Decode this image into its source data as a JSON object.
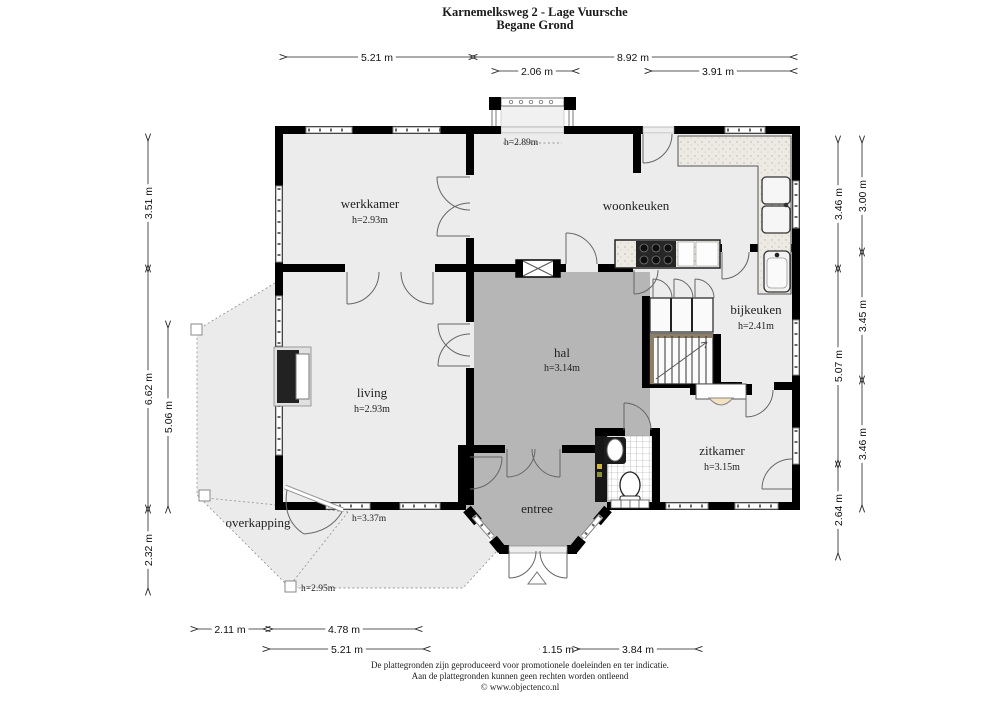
{
  "title": {
    "line1": "Karnemelksweg 2 - Lage Vuursche",
    "line2": "Begane Grond"
  },
  "rooms": {
    "werkkamer": {
      "label": "werkkamer",
      "height": "h=2.93m"
    },
    "woonkeuken": {
      "label": "woonkeuken"
    },
    "bijkeuken": {
      "label": "bijkeuken",
      "height": "h=2.41m"
    },
    "hal": {
      "label": "hal",
      "height": "h=3.14m"
    },
    "living": {
      "label": "living",
      "height": "h=2.93m"
    },
    "zitkamer": {
      "label": "zitkamer",
      "height": "h=3.15m"
    },
    "entree": {
      "label": "entree"
    },
    "overkapping": {
      "label": "overkapping"
    }
  },
  "height_labels": {
    "balcony": "h=2.89m",
    "terrace_door": "h=3.37m",
    "terrace_edge": "h=2.95m"
  },
  "dimensions": {
    "top": [
      "5.21 m",
      "8.92 m",
      "2.06 m",
      "3.91 m"
    ],
    "left": [
      "3.51 m",
      "6.62 m",
      "2.32 m",
      "5.06 m"
    ],
    "right_inner": [
      "3.46 m",
      "5.07 m",
      "2.64 m"
    ],
    "right_outer": [
      "3.00 m",
      "3.45 m",
      "3.46 m"
    ],
    "bottom": [
      "2.11 m",
      "4.78 m",
      "5.21 m",
      "1.15 m",
      "3.84 m"
    ]
  },
  "footer": {
    "line1": "De plattegronden zijn geproduceerd voor promotionele doeleinden en ter indicatie.",
    "line2": "Aan de plattegronden kunnen geen rechten worden ontleend",
    "line3": "© www.objectenco.nl"
  },
  "colors": {
    "wall": "#000000",
    "room_fill": "#ececec",
    "hall_fill": "#b6b6b6",
    "canopy_fill": "#ebebeb"
  }
}
